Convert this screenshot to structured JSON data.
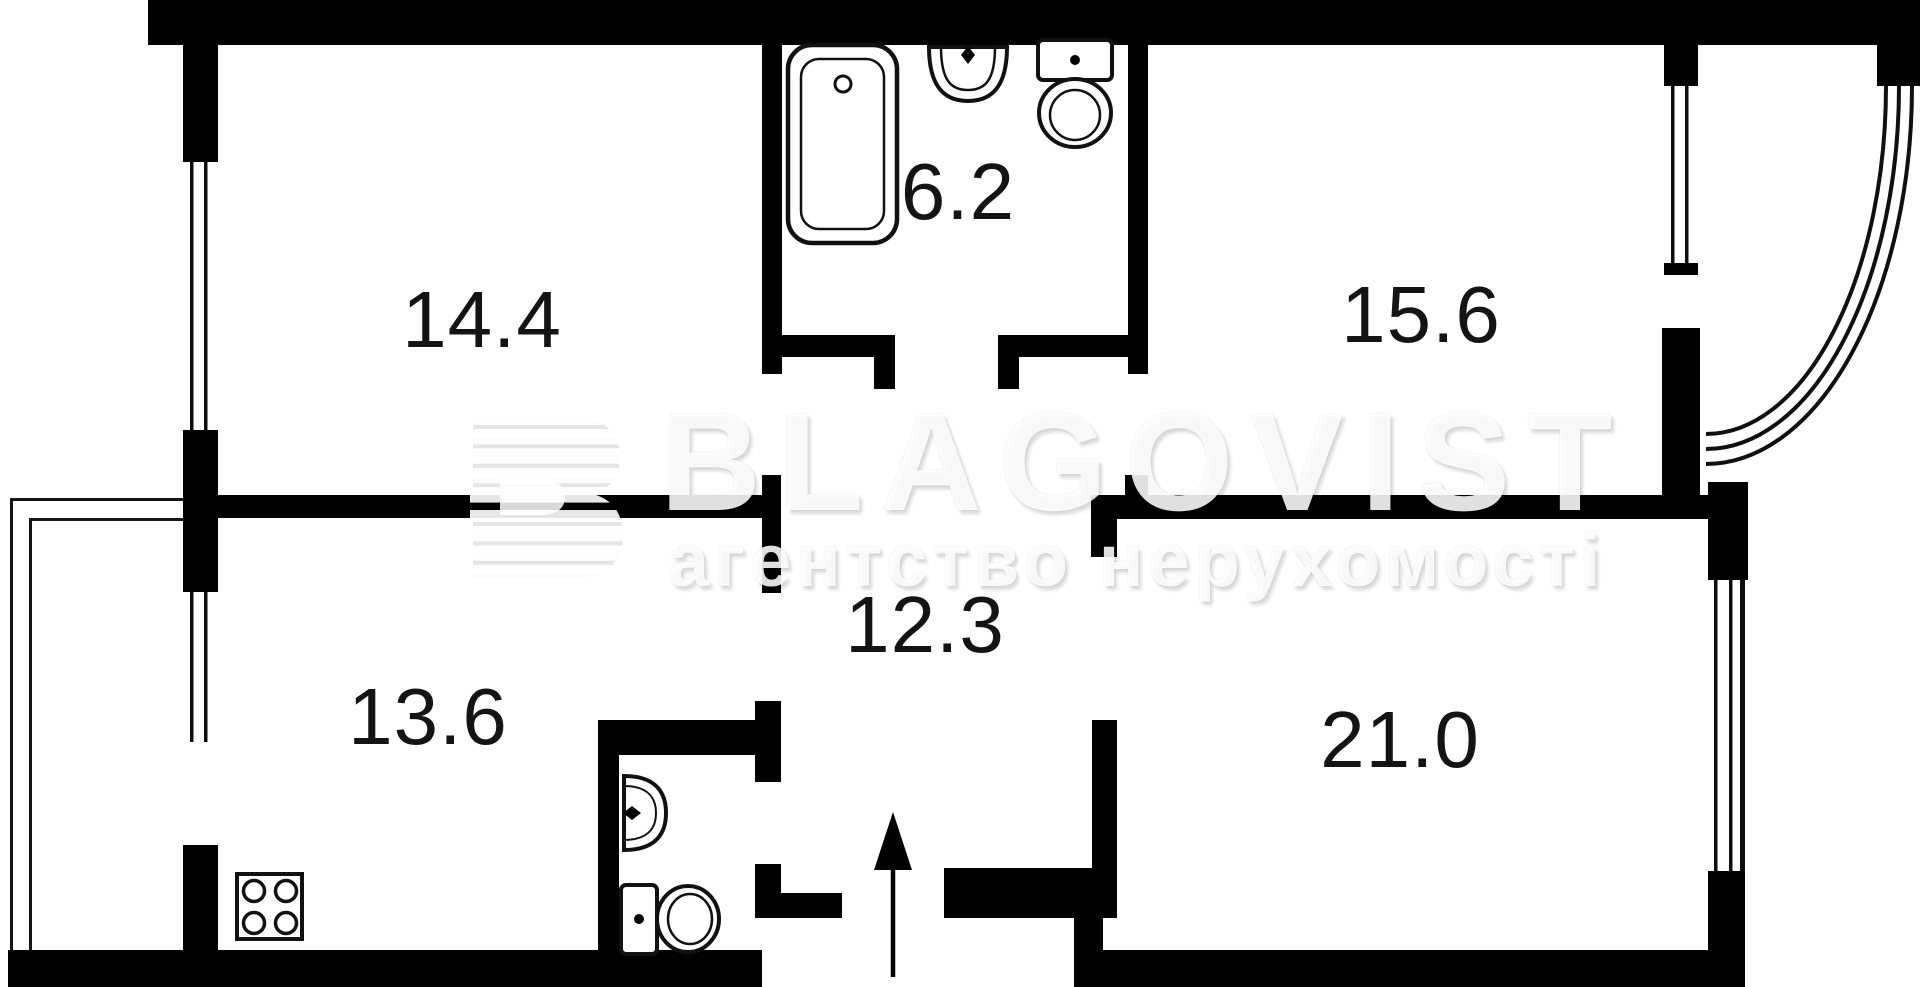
{
  "floorplan": {
    "type": "apartment-floor-plan",
    "room_areas": [
      {
        "id": "room-top-left",
        "area": "14.4"
      },
      {
        "id": "bathroom",
        "area": "6.2"
      },
      {
        "id": "room-top-right",
        "area": "15.6"
      },
      {
        "id": "hallway",
        "area": "12.3"
      },
      {
        "id": "kitchen",
        "area": "13.6"
      },
      {
        "id": "room-bottom-right",
        "area": "21.0"
      }
    ],
    "fixtures": [
      "bathtub-icon",
      "bathroom-sink-icon",
      "bathroom-toilet-icon",
      "wc-sink-icon",
      "wc-toilet-icon",
      "stove-icon",
      "entrance-arrow-icon",
      "balcony-railing",
      "bay-balcony-arc",
      "window"
    ],
    "watermark": {
      "brand": "BLAGOVIST",
      "tagline": "агентство нерухомості"
    },
    "colors": {
      "wall": "#000000",
      "background": "#ffffff",
      "label": "#141414",
      "watermark_text": "#f2f2f2"
    }
  }
}
